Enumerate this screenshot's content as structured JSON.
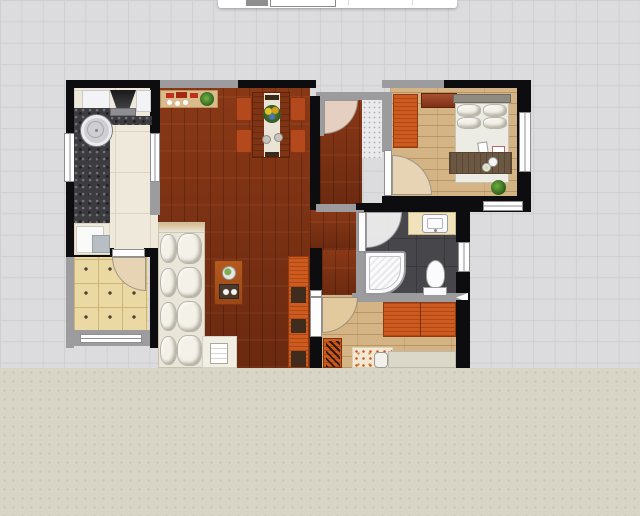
{
  "app": {
    "type": "floor-plan-editor-canvas",
    "visible_text": "",
    "toolbar_partial": {
      "description": "bottom sliver of a white toolbar/dialog cut off at top edge",
      "controls": [
        "gray-chip",
        "outlined-input-box",
        "separator",
        "separator"
      ]
    }
  },
  "colors": {
    "grid_bg": "#dcdcde",
    "grid_line": "#cfcfd2",
    "wall_black": "#0d0d0f",
    "wall_gray": "#9c9c9e",
    "window_frame": "#8f8f91",
    "floor_living": "#7c3013",
    "floor_bedroom": "#d4b384",
    "floor_kitchen": "#efe9db",
    "kitchen_line": "#ddd3c0",
    "floor_balcony": "#ebd9a3",
    "balcony_line": "#cfb276",
    "balcony_dot": "#4f4230",
    "floor_bath": "#47474b",
    "bath_line": "#39393d",
    "overlay_beige": "#d8d4c6",
    "overlay_dot": "#cac6b7",
    "counter_granite": "#3c3c40",
    "cabinet_white": "#f3f3f5",
    "appliance_gray": "#b7bfc5",
    "wood_orange": "#cd5a1e",
    "table_wood": "#7e3414",
    "runner_cream": "#eae4d6",
    "chair_orange": "#b4491d",
    "sideboard_wood": "#d9bb8d",
    "sofa_cream": "#e9e5d8",
    "cushion_white": "#f4f1e9",
    "cushion_shadow": "#b9b5a8",
    "coffee_wood": "#b45a20",
    "vanity_cream": "#f0e3bc",
    "fixture_white": "#fbfbfd",
    "bed_duvet": "#edece4",
    "pillow_white": "#f3f0e8",
    "headboard_gray": "#8f8b81",
    "throw_brown": "#6c5742",
    "fan_pink": "#e5cfc0",
    "fan_cream": "#e7d4b5",
    "fan_wood": "#e2c99e",
    "plant_green": "#3f7a2a",
    "foyer_tile": "#eaeaec",
    "rug_cream": "#f2e8d4"
  },
  "rooms": [
    {
      "name": "kitchen",
      "furniture": [
        "upper-cabinet",
        "range-hood",
        "granite-counter",
        "round-sink",
        "lower-counter",
        "appliance"
      ]
    },
    {
      "name": "balcony",
      "furniture": [
        "tiled-floor",
        "door-arc",
        "window"
      ]
    },
    {
      "name": "living-dining-room",
      "furniture": [
        "sideboard",
        "potted-plant",
        "dining-table",
        "table-runner",
        "flower-centerpiece",
        "4-chairs",
        "sofa",
        "ottoman-with-magazine",
        "coffee-table",
        "tv-cabinet"
      ]
    },
    {
      "name": "entry-hall",
      "furniture": [
        "entry-door-arc",
        "foyer-tile"
      ]
    },
    {
      "name": "bedroom-1",
      "furniture": [
        "wardrobe",
        "wall-shelf",
        "double-bed",
        "pillows",
        "throw-blanket",
        "breakfast-tray",
        "magazines",
        "potted-plant",
        "door-arc",
        "window"
      ]
    },
    {
      "name": "bathroom",
      "furniture": [
        "vanity-sink",
        "toilet",
        "shower-stall",
        "door-arc",
        "window"
      ]
    },
    {
      "name": "bedroom-2",
      "furniture": [
        "dresser",
        "cabinet-with-plant",
        "rug",
        "bed-partial",
        "door-arc"
      ]
    }
  ],
  "canvas": {
    "width": 640,
    "height": 516,
    "grid_step_px": 21.33,
    "beige_slab_top_y": 368
  }
}
